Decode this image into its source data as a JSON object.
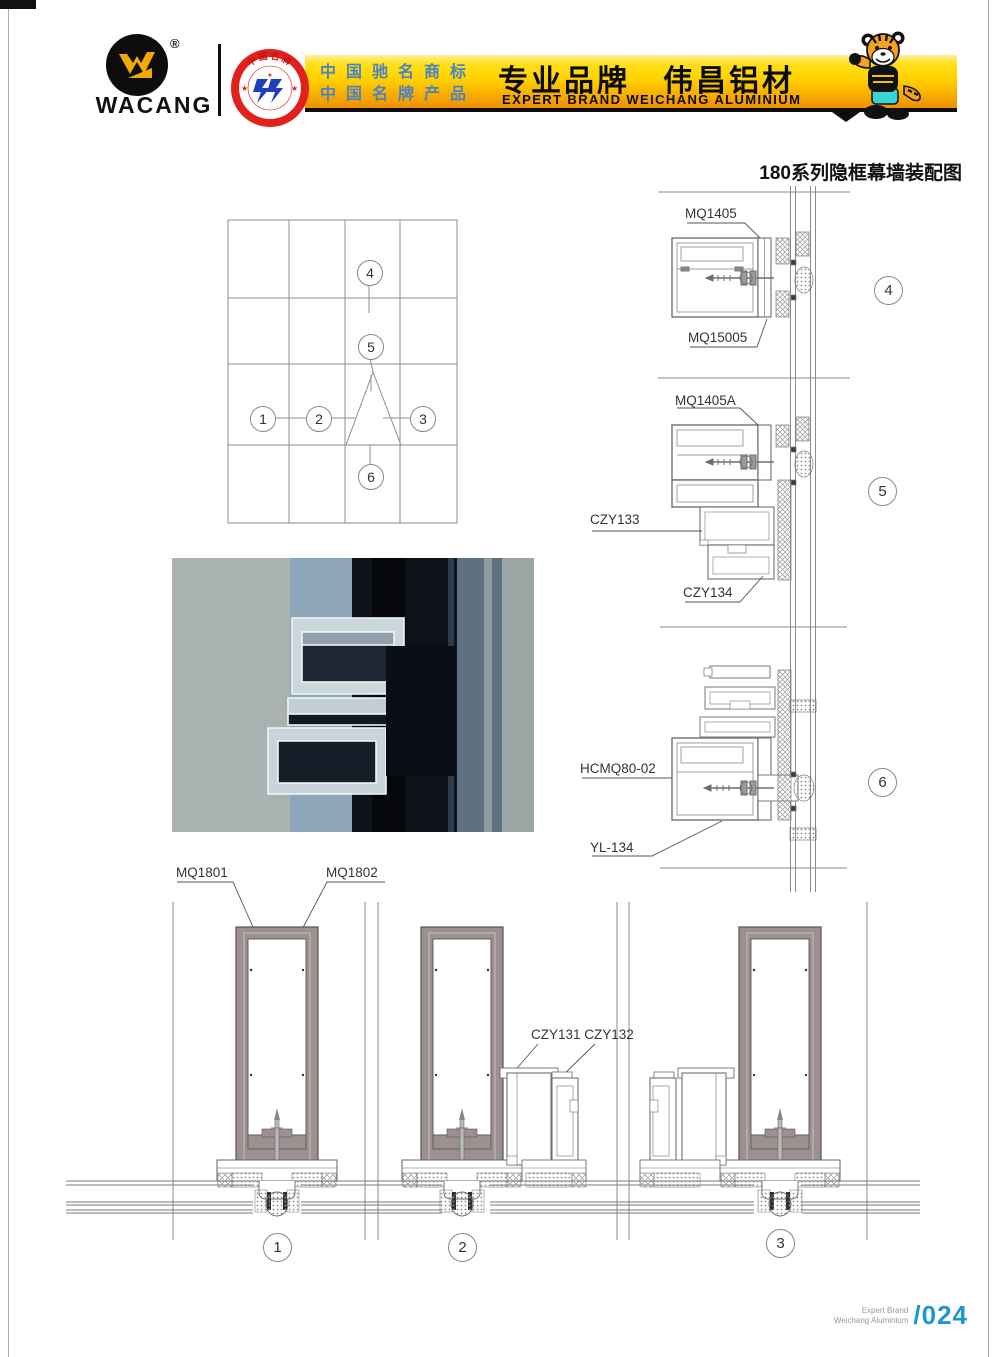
{
  "header": {
    "logo": {
      "text": "WACANG",
      "registered": "®"
    },
    "badge": {
      "arc_top": "中国名牌",
      "arc_bottom": "CHINA TOP BRAND"
    },
    "banner": {
      "tagline_line1": "中国驰名商标",
      "tagline_line2": "中国名牌产品",
      "brand_cn": "专业品牌　伟昌铝材",
      "brand_en": "EXPERT BRAND WEICHANG ALUMINIUM"
    }
  },
  "drawing": {
    "title": "180系列隐框幕墙装配图",
    "labels": {
      "mq1405": "MQ1405",
      "mq15005": "MQ15005",
      "mq1405a": "MQ1405A",
      "czy133": "CZY133",
      "czy134": "CZY134",
      "hcmq80_02": "HCMQ80-02",
      "yl134": "YL-134",
      "mq1801": "MQ1801",
      "mq1802": "MQ1802",
      "czy131_132": "CZY131 CZY132"
    },
    "callouts": {
      "c1": "1",
      "c2": "2",
      "c3": "3",
      "c4": "4",
      "c5": "5",
      "c6": "6"
    }
  },
  "footer": {
    "brand_line1": "Expert Brand",
    "brand_line2": "Weichang Aluminium",
    "page_number": "/024"
  },
  "colors": {
    "banner_yellow": "#FFD200",
    "banner_orange": "#EF9000",
    "tagline_blue": "#4B83C5",
    "badge_red": "#E2201E",
    "page_number_blue": "#1E96D2",
    "drawing_grey": "#8A8A8A",
    "frame_fill": "#9C9191"
  }
}
